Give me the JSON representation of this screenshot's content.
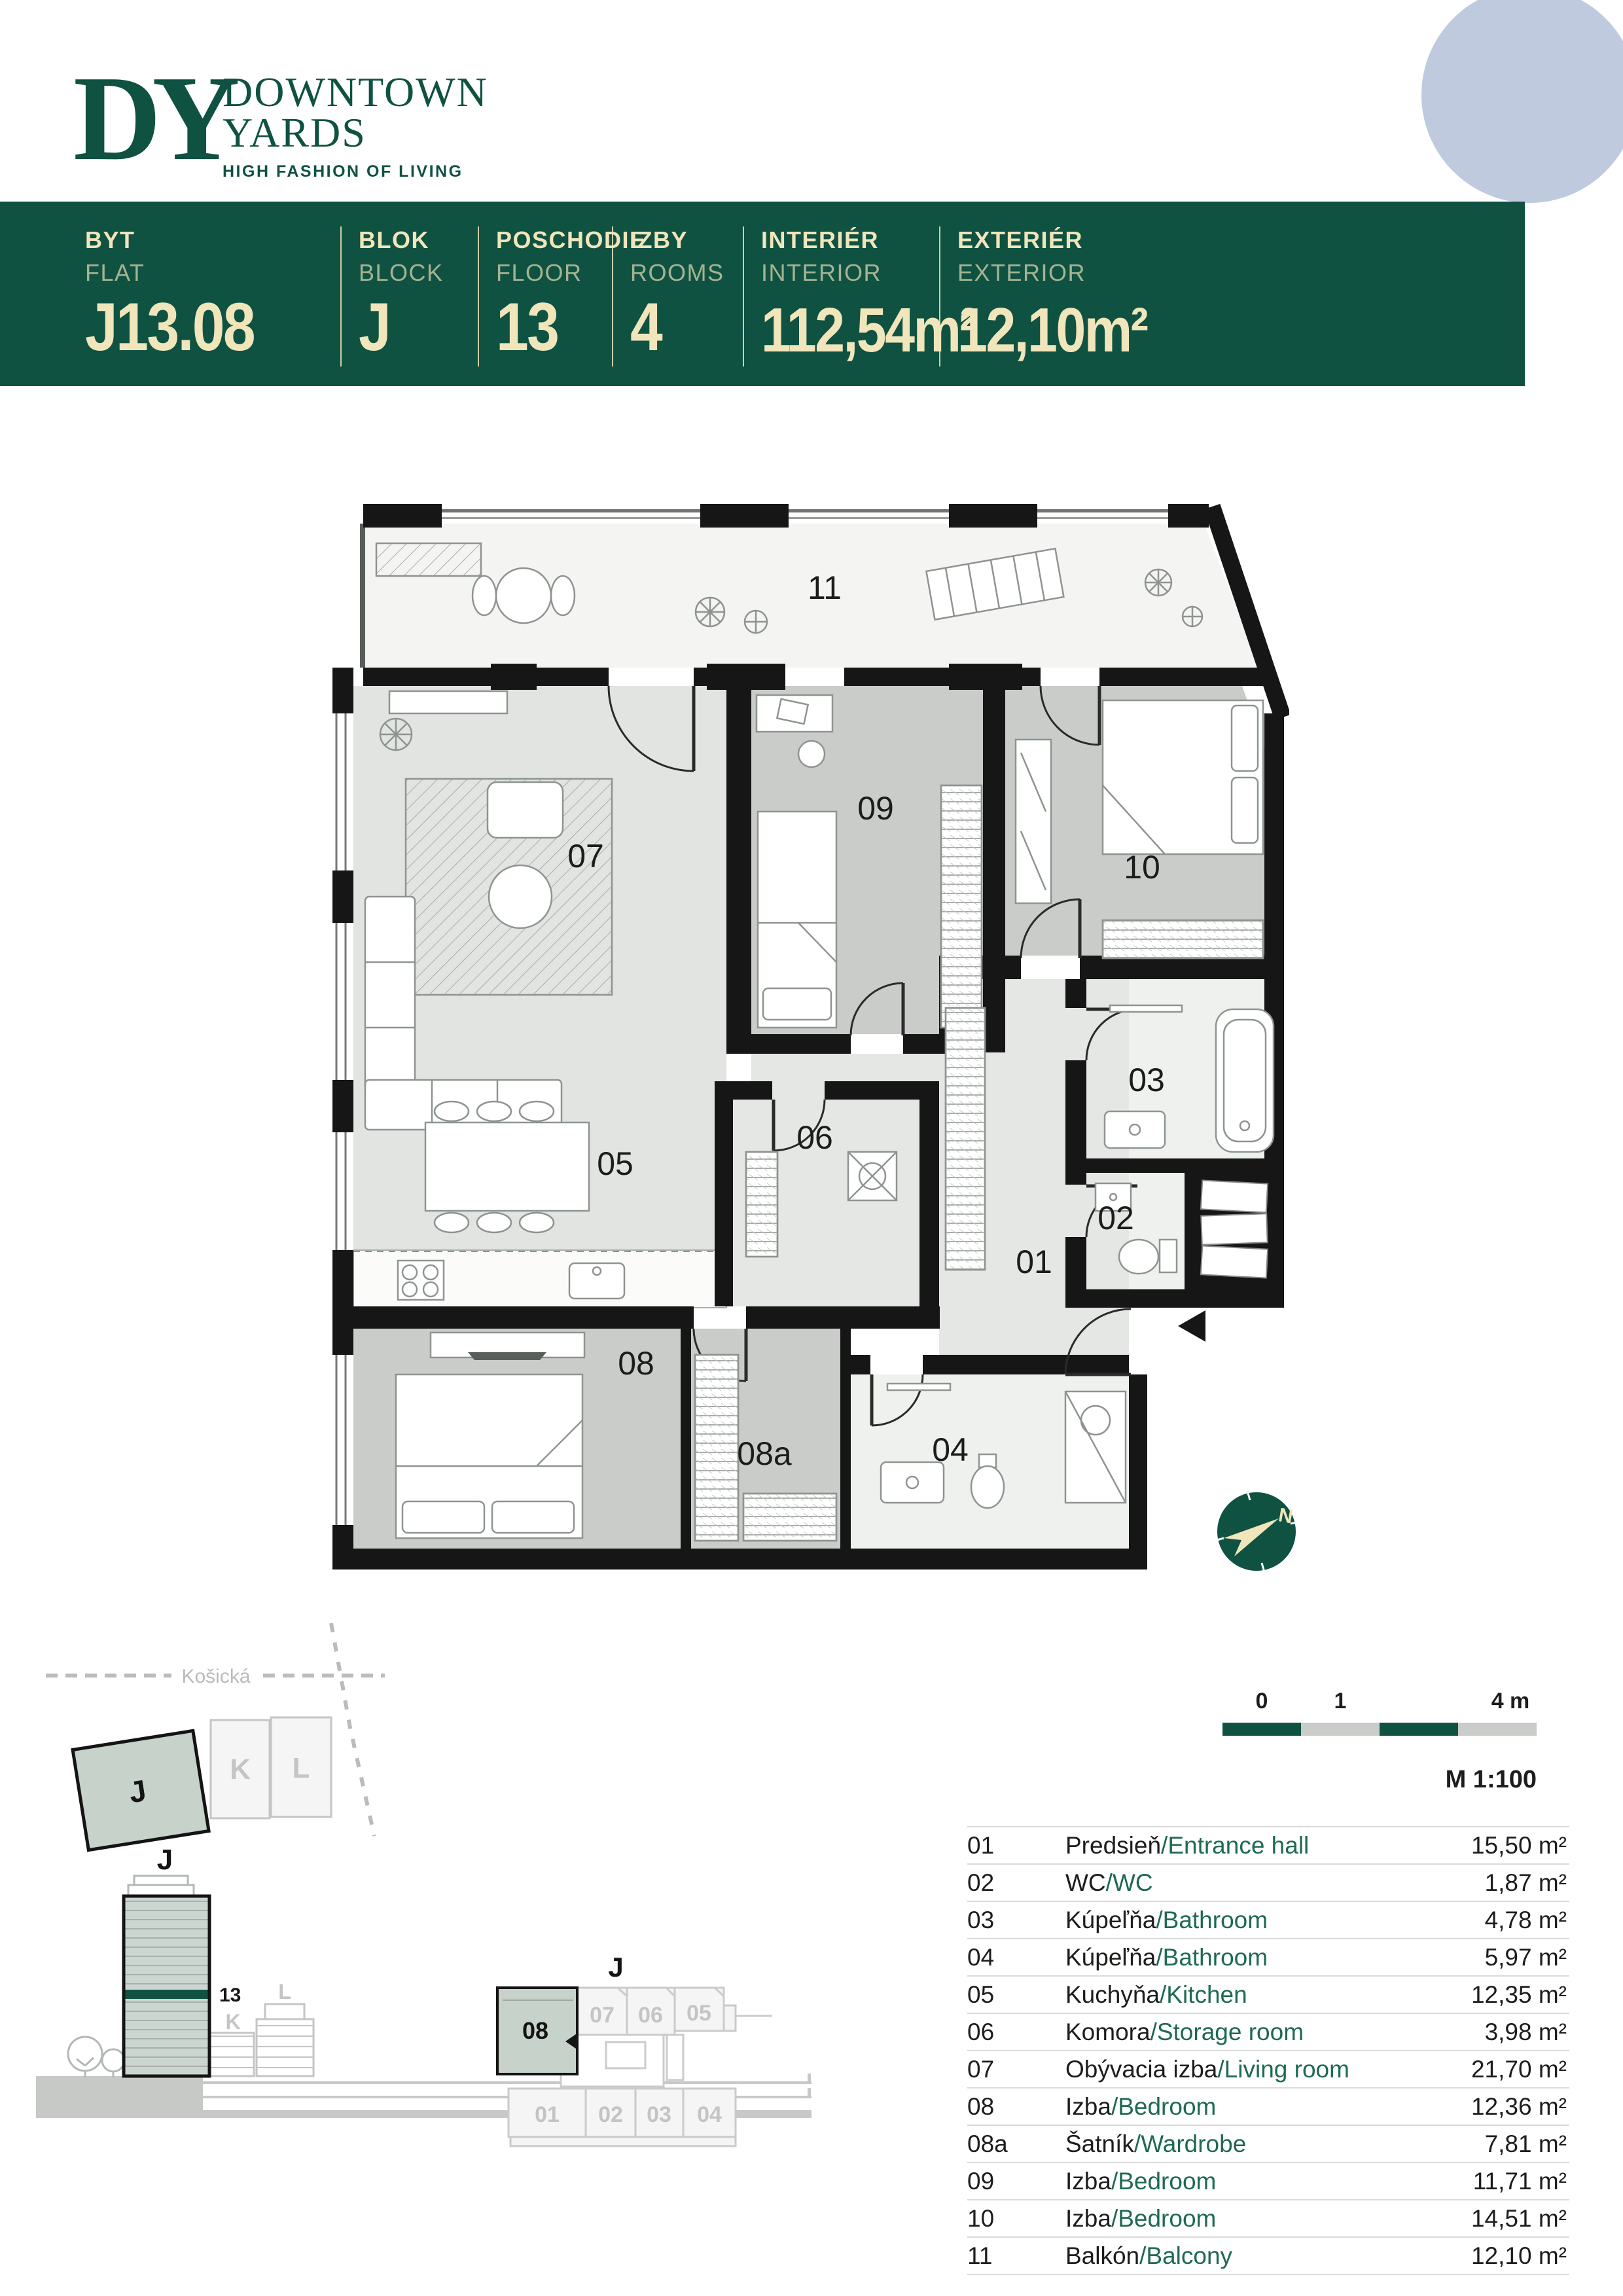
{
  "header": {
    "monogram": "DY",
    "line1": "DOWNTOWN",
    "line2": "YARDS",
    "tagline": "HIGH FASHION OF LIVING"
  },
  "banner": {
    "columns": [
      {
        "label_sk": "BYT",
        "label_en": "FLAT",
        "value": "J13.08"
      },
      {
        "label_sk": "BLOK",
        "label_en": "BLOCK",
        "value": "J"
      },
      {
        "label_sk": "POSCHODIE",
        "label_en": "FLOOR",
        "value": "13"
      },
      {
        "label_sk": "IZBY",
        "label_en": "ROOMS",
        "value": "4"
      },
      {
        "label_sk": "INTERIÉR",
        "label_en": "INTERIOR",
        "value": "112,54m²"
      },
      {
        "label_sk": "EXTERIÉR",
        "label_en": "EXTERIOR",
        "value": "12,10m²"
      }
    ]
  },
  "plan": {
    "labels": {
      "r01": "01",
      "r02": "02",
      "r03": "03",
      "r04": "04",
      "r05": "05",
      "r06": "06",
      "r07": "07",
      "r08": "08",
      "r08a": "08a",
      "r09": "09",
      "r10": "10",
      "r11": "11"
    }
  },
  "compass": {
    "north": "N"
  },
  "site_plan": {
    "street": "Košická",
    "blocks": [
      "J",
      "K",
      "L"
    ]
  },
  "elevation": {
    "tower": "J",
    "floor_marker": "13",
    "neighbors": [
      "K",
      "L"
    ]
  },
  "key_plan": {
    "building": "J",
    "top_units": [
      "08",
      "07",
      "06",
      "05"
    ],
    "bottom_units": [
      "01",
      "02",
      "03",
      "04"
    ]
  },
  "scale_bar": {
    "ticks": [
      "0",
      "1",
      "4 m"
    ],
    "scale_label": "M 1:100"
  },
  "legend": {
    "separator": "/",
    "rows": [
      {
        "id": "01",
        "name_sk": "Predsieň",
        "name_en": "Entrance hall",
        "area": "15,50 m²"
      },
      {
        "id": "02",
        "name_sk": "WC",
        "name_en": "WC",
        "area": "1,87 m²"
      },
      {
        "id": "03",
        "name_sk": "Kúpeľňa",
        "name_en": "Bathroom",
        "area": "4,78 m²"
      },
      {
        "id": "04",
        "name_sk": "Kúpeľňa",
        "name_en": "Bathroom",
        "area": "5,97 m²"
      },
      {
        "id": "05",
        "name_sk": "Kuchyňa",
        "name_en": "Kitchen",
        "area": "12,35 m²"
      },
      {
        "id": "06",
        "name_sk": "Komora",
        "name_en": "Storage room",
        "area": "3,98 m²"
      },
      {
        "id": "07",
        "name_sk": "Obývacia izba",
        "name_en": "Living room",
        "area": "21,70 m²"
      },
      {
        "id": "08",
        "name_sk": "Izba",
        "name_en": "Bedroom",
        "area": "12,36 m²"
      },
      {
        "id": "08a",
        "name_sk": "Šatník",
        "name_en": "Wardrobe",
        "area": "7,81 m²"
      },
      {
        "id": "09",
        "name_sk": "Izba",
        "name_en": "Bedroom",
        "area": "11,71 m²"
      },
      {
        "id": "10",
        "name_sk": "Izba",
        "name_en": "Bedroom",
        "area": "14,51 m²"
      },
      {
        "id": "11",
        "name_sk": "Balkón",
        "name_en": "Balcony",
        "area": "12,10 m²"
      }
    ]
  },
  "colors": {
    "brand_green": "#0F5242",
    "legend_green": "#1E6A50",
    "cream": "#F1E5BB",
    "circle_blue": "#BFCADF",
    "unit_fill": "#C7D2CB"
  }
}
